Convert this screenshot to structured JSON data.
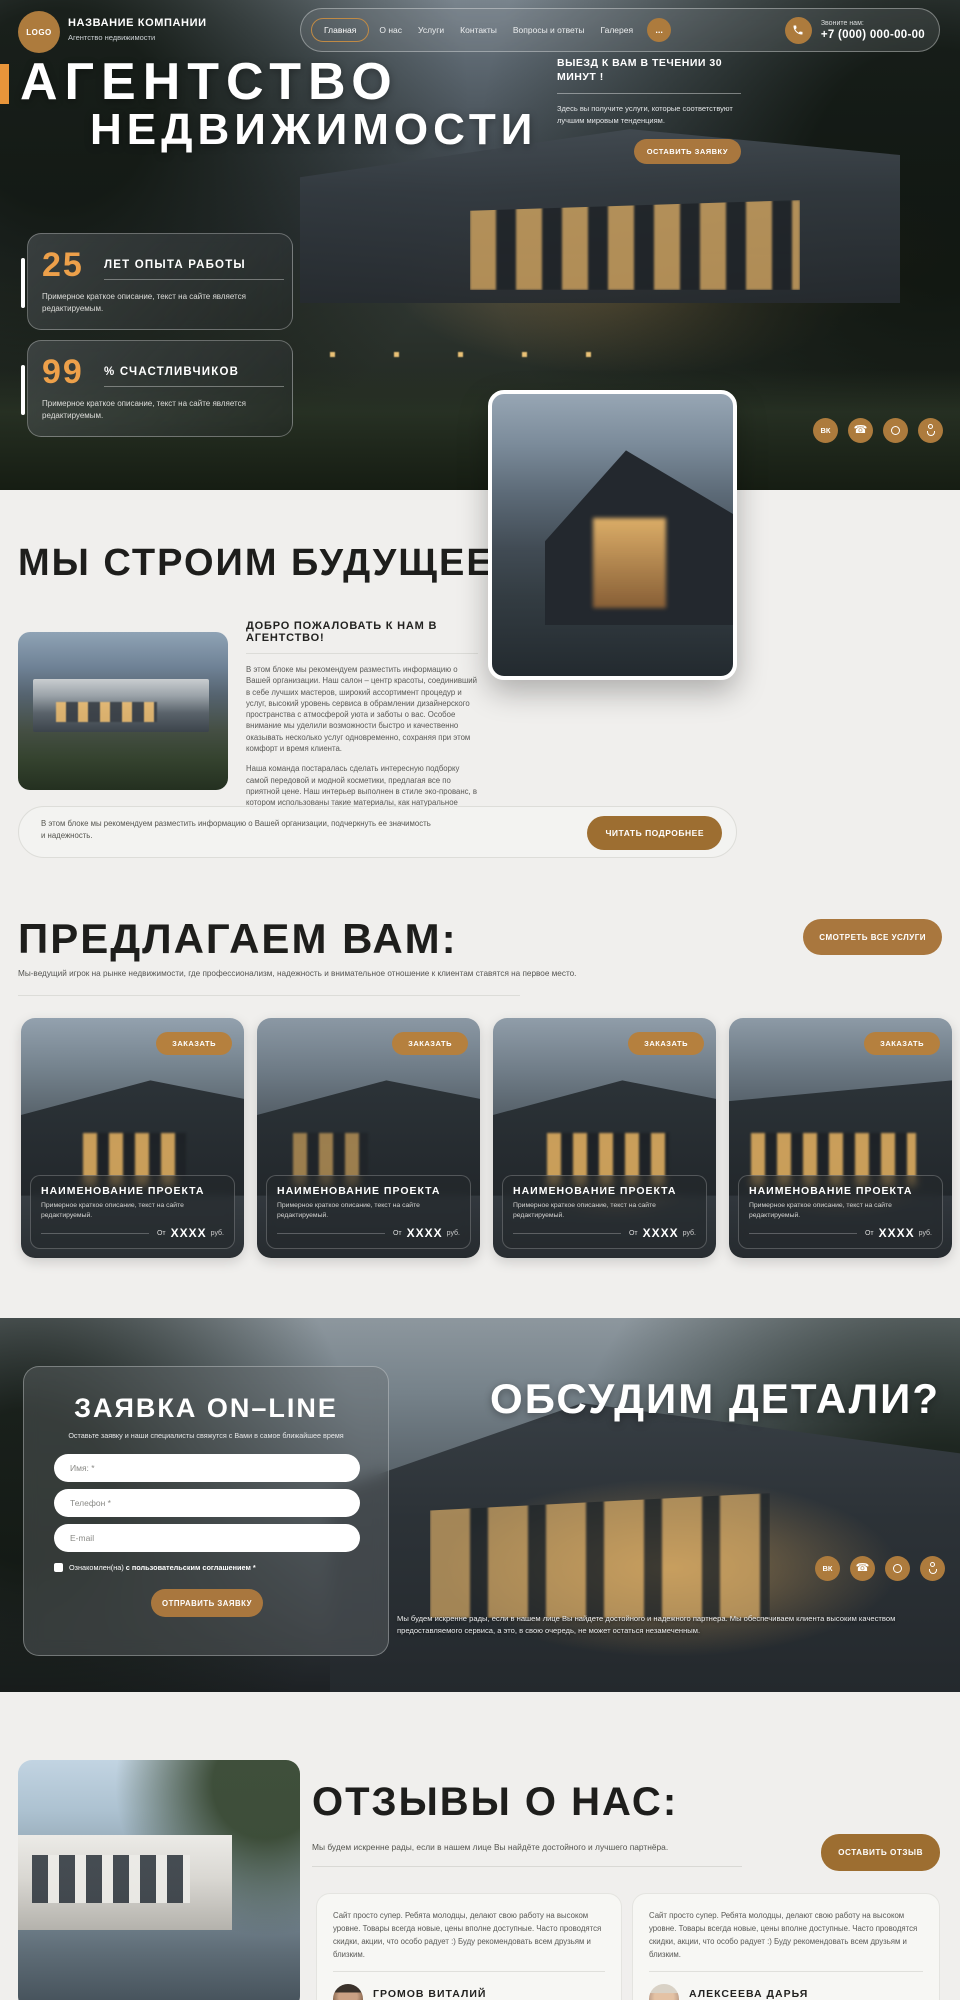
{
  "brand": {
    "logo": "LOGO",
    "name": "НАЗВАНИЕ КОМПАНИИ",
    "tagline": "Агентство недвижимости"
  },
  "nav": {
    "items": [
      "Главная",
      "О нас",
      "Услуги",
      "Контакты",
      "Вопросы и ответы",
      "Галерея"
    ],
    "more": "...",
    "call_label": "Звоните нам:",
    "phone": "+7 (000) 000-00-00"
  },
  "hero": {
    "title_line1": "АГЕНТСТВО",
    "title_line2": "НЕДВИЖИМОСТИ",
    "promo_title": "ВЫЕЗД К ВАМ В ТЕЧЕНИИ 30 МИНУТ !",
    "promo_text": "Здесь вы получите услуги, которые соответствуют лучшим мировым тенденциям.",
    "cta": "ОСТАВИТЬ ЗАЯВКУ",
    "stats": [
      {
        "value": "25",
        "label": "ЛЕТ ОПЫТА РАБОТЫ",
        "text": "Примерное краткое описание, текст на сайте является редактируемым."
      },
      {
        "value": "99",
        "label": "% СЧАСТЛИВЧИКОВ",
        "text": "Примерное краткое описание, текст на сайте является редактируемым."
      }
    ]
  },
  "about": {
    "heading": "МЫ СТРОИМ БУДУЩЕЕ",
    "subheading": "ДОБРО ПОЖАЛОВАТЬ К НАМ В АГЕНТСТВО!",
    "paragraph1": "В этом блоке мы рекомендуем разместить информацию о Вашей организации. Наш салон –  центр красоты, соединивший в себе лучших мастеров, широкий ассортимент процедур и услуг, высокий уровень сервиса в обрамлении дизайнерского пространства с атмосферой уюта и заботы о вас. Особое внимание мы уделили возможности быстро и качественно оказывать несколько услуг одновременно, сохраняя при этом комфорт и время клиента.",
    "paragraph2": "Наша команда постаралась сделать интересную подборку самой передовой и модной косметики, предлагая все по приятной цене. Наш интерьер выполнен в стиле эко-прованс, в котором использованы такие материалы, как натуральное дерево и живые растения. У нас работают только опытные специалисты!",
    "callout_text": "В этом блоке мы рекомендуем разместить информацию о Вашей организации, подчеркнуть ее значимость и надежность.",
    "callout_button": "ЧИТАТЬ ПОДРОБНЕЕ"
  },
  "services": {
    "heading": "ПРЕДЛАГАЕМ ВАМ:",
    "button": "СМОТРЕТЬ ВСЕ УСЛУГИ",
    "subtitle": "Мы-ведущий игрок на рынке недвижимости, где профессионализм, надежность и внимательное отношение к клиентам ставятся на первое место.",
    "cards": [
      {
        "order": "ЗАКАЗАТЬ",
        "title": "НАИМЕНОВАНИЕ ПРОЕКТА",
        "text": "Примерное краткое описание, текст на сайте редактируемый.",
        "price_prefix": "От",
        "price": "XXXX",
        "price_suffix": "руб."
      },
      {
        "order": "ЗАКАЗАТЬ",
        "title": "НАИМЕНОВАНИЕ ПРОЕКТА",
        "text": "Примерное краткое описание, текст на сайте редактируемый.",
        "price_prefix": "От",
        "price": "XXXX",
        "price_suffix": "руб."
      },
      {
        "order": "ЗАКАЗАТЬ",
        "title": "НАИМЕНОВАНИЕ ПРОЕКТА",
        "text": "Примерное краткое описание, текст на сайте редактируемый.",
        "price_prefix": "От",
        "price": "XXXX",
        "price_suffix": "руб."
      },
      {
        "order": "ЗАКАЗАТЬ",
        "title": "НАИМЕНОВАНИЕ ПРОЕКТА",
        "text": "Примерное краткое описание, текст на сайте редактируемый.",
        "price_prefix": "От",
        "price": "XXXX",
        "price_suffix": "руб."
      }
    ]
  },
  "form_section": {
    "heading": "ОБСУДИМ ДЕТАЛИ?",
    "form_title": "ЗАЯВКА ON–LINE",
    "form_subtitle": "Оставьте заявку и наши специалисты свяжутся с Вами в самое ближайшее время",
    "fields": [
      {
        "placeholder": "Имя: *"
      },
      {
        "placeholder": "Телефон *"
      },
      {
        "placeholder": "E-mail"
      }
    ],
    "agreement_normal": "Ознакомлен(на) ",
    "agreement_bold": "с пользовательским соглашением *",
    "submit": "ОТПРАВИТЬ ЗАЯВКУ",
    "note": "Мы будем искренне рады, если в нашем лице Вы найдете достойного и надежного партнера. Мы обеспечиваем клиента высоким качеством предоставляемого сервиса, а это, в свою очередь, не может остаться незамеченным."
  },
  "reviews": {
    "heading": "ОТЗЫВЫ О НАС:",
    "subtitle": "Мы будем искренне рады, если в нашем лице Вы найдёте достойного и лучшего партнёра.",
    "button": "ОСТАВИТЬ ОТЗЫВ",
    "items": [
      {
        "text": "Сайт просто супер. Ребята молодцы, делают свою работу на высоком уровне. Товары всегда новые, цены вполне доступные. Часто проводятся скидки, акции, что особо радует :) Буду рекомендовать всем друзьям и близким.",
        "name": "ГРОМОВ ВИТАЛИЙ",
        "date": "01.01.2026 г."
      },
      {
        "text": "Сайт просто супер. Ребята молодцы, делают свою работу на высоком уровне. Товары всегда новые, цены вполне доступные. Часто проводятся скидки, акции, что особо радует :) Буду рекомендовать всем друзьям и близким.",
        "name": "АЛЕКСЕЕВА ДАРЬЯ",
        "date": "01.01.2026 г."
      }
    ]
  },
  "colors": {
    "accent_brown": "#a9773e",
    "accent_circle": "#ad7b3d",
    "number_orange": "#eda04a",
    "bar_orange": "#e8953a",
    "light_bg": "#f0efed"
  }
}
